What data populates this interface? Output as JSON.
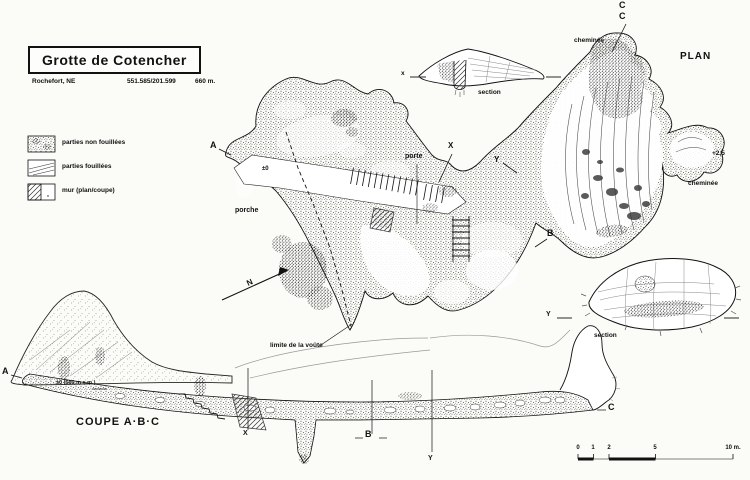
{
  "header": {
    "title": "Grotte de Cotencher",
    "locality": "Rochefort, NE",
    "coordinates": "551.585/201.599",
    "altitude": "660 m."
  },
  "legend": {
    "items": [
      {
        "label": "parties non fouillées"
      },
      {
        "label": "parties fouillées"
      },
      {
        "label": "mur (plan/coupe)"
      }
    ]
  },
  "plan": {
    "caption": "PLAN",
    "point_a": "A",
    "point_b": "B",
    "point_c1": "C",
    "point_c2": "C",
    "point_x": "X",
    "point_y": "Y",
    "door": "porte",
    "porch": "porche",
    "chimney_top": "cheminée",
    "chimney_right": "cheminée",
    "datum": "±0",
    "elevation": "+2,5",
    "vault_limit": "limite de la voûte",
    "north": "N"
  },
  "section_top": {
    "left_mark": "x",
    "caption": "section"
  },
  "section_bottom": {
    "left_mark": "Y",
    "caption": "section"
  },
  "coupe": {
    "title": "COUPE A·B·C",
    "point_a": "A",
    "point_b": "B",
    "point_c": "C",
    "point_x": "X",
    "point_y": "Y",
    "datum": "±0 (660 m s.m.)"
  },
  "scalebar": {
    "labels": [
      "0",
      "1",
      "2",
      "5"
    ],
    "end_label": "10 m."
  }
}
